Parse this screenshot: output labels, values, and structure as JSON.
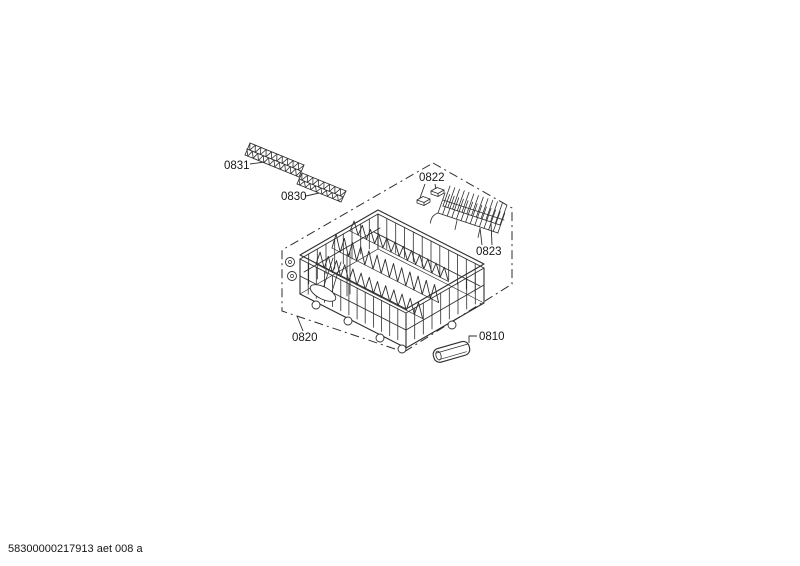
{
  "colors": {
    "background": "#ffffff",
    "line": "#2e2e2e",
    "label_text": "#161616"
  },
  "diagram": {
    "footer_code": "58300000217913 aet 008 a",
    "parts": [
      {
        "label": "0831"
      },
      {
        "label": "0830"
      },
      {
        "label": "0822"
      },
      {
        "label": "0823"
      },
      {
        "label": "0820"
      },
      {
        "label": "0810"
      }
    ]
  }
}
